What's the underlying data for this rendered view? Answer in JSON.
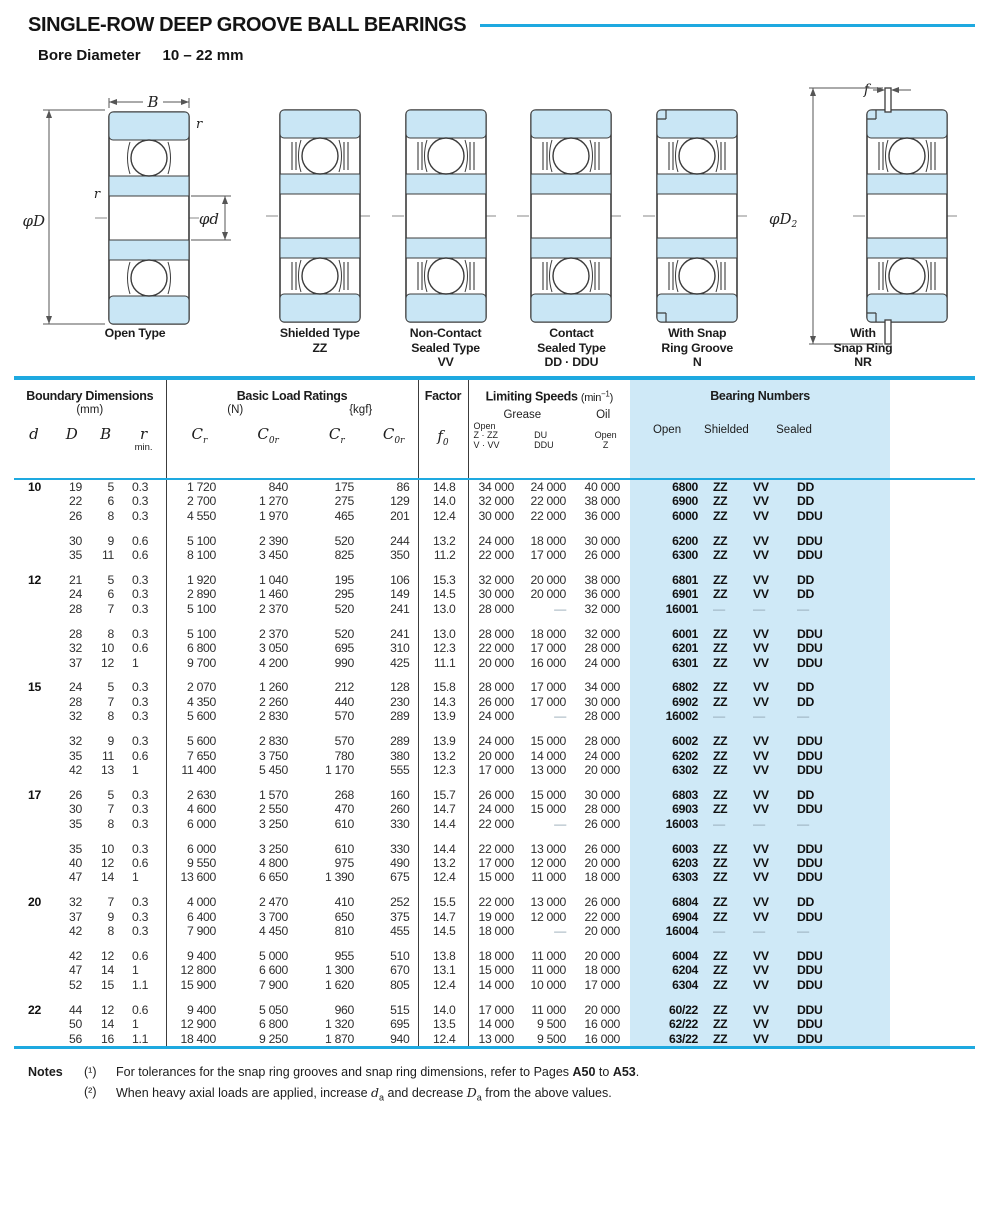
{
  "title": "SINGLE-ROW DEEP GROOVE BALL BEARINGS",
  "bore": {
    "label": "Bore Diameter",
    "value": "10 – 22 mm"
  },
  "colors": {
    "accent": "#1ea9e0",
    "panel": "#cfe9f7",
    "diagram_fill": "#c9e6f5"
  },
  "diagrams": [
    {
      "type": "open",
      "lines": [
        "Open Type",
        "",
        ""
      ]
    },
    {
      "type": "shielded",
      "lines": [
        "Shielded Type",
        "ZZ",
        ""
      ]
    },
    {
      "type": "vv",
      "lines": [
        "Non-Contact",
        "Sealed Type",
        "VV"
      ]
    },
    {
      "type": "dd",
      "lines": [
        "Contact",
        "Sealed Type",
        "DD · DDU"
      ]
    },
    {
      "type": "groove",
      "lines": [
        "With Snap",
        "Ring Groove",
        "N"
      ]
    },
    {
      "type": "ring",
      "lines": [
        "With",
        "Snap Ring",
        "NR"
      ]
    }
  ],
  "annotations": {
    "B": "B",
    "r": "r",
    "phiD": "φD",
    "phid": "φd",
    "f": "f",
    "phiD2": "φD",
    "phiD2_sub": "2"
  },
  "thead": {
    "boundary": {
      "title": "Boundary Dimensions",
      "unit": "(mm)",
      "d": "d",
      "D": "D",
      "B": "B",
      "r": "r",
      "r_min": "min."
    },
    "load": {
      "title": "Basic Load Ratings",
      "unit_n": "(N)",
      "unit_kgf": "{kgf}",
      "c": "C",
      "sub_r": "r",
      "sub_0r": "0r"
    },
    "factor": {
      "title": "Factor",
      "f": "f",
      "f_sub": "0"
    },
    "speeds": {
      "title": "Limiting Speeds",
      "unit_pre": "(min",
      "unit_sup": "−1",
      "unit_post": ")",
      "grease": "Grease",
      "oil": "Oil",
      "g1": [
        "Open",
        "Z · ZZ",
        "V · VV"
      ],
      "g2": [
        "DU",
        "DDU"
      ],
      "g3": [
        "Open",
        "Z"
      ]
    },
    "bearings": {
      "title": "Bearing Numbers",
      "open": "Open",
      "shielded": "Shielded",
      "sealed": "Sealed"
    }
  },
  "table": {
    "blocks": [
      {
        "d": "10",
        "rows": [
          [
            "19",
            "5",
            "0.3",
            "1 720",
            "840",
            "175",
            "86",
            "14.8",
            "34 000",
            "24 000",
            "40 000",
            "6800",
            "ZZ",
            "VV",
            "DD"
          ],
          [
            "22",
            "6",
            "0.3",
            "2 700",
            "1 270",
            "275",
            "129",
            "14.0",
            "32 000",
            "22 000",
            "38 000",
            "6900",
            "ZZ",
            "VV",
            "DD"
          ],
          [
            "26",
            "8",
            "0.3",
            "4 550",
            "1 970",
            "465",
            "201",
            "12.4",
            "30 000",
            "22 000",
            "36 000",
            "6000",
            "ZZ",
            "VV",
            "DDU"
          ]
        ]
      },
      {
        "d": "",
        "rows": [
          [
            "30",
            "9",
            "0.6",
            "5 100",
            "2 390",
            "520",
            "244",
            "13.2",
            "24 000",
            "18 000",
            "30 000",
            "6200",
            "ZZ",
            "VV",
            "DDU"
          ],
          [
            "35",
            "11",
            "0.6",
            "8 100",
            "3 450",
            "825",
            "350",
            "11.2",
            "22 000",
            "17 000",
            "26 000",
            "6300",
            "ZZ",
            "VV",
            "DDU"
          ]
        ]
      },
      {
        "d": "12",
        "rows": [
          [
            "21",
            "5",
            "0.3",
            "1 920",
            "1 040",
            "195",
            "106",
            "15.3",
            "32 000",
            "20 000",
            "38 000",
            "6801",
            "ZZ",
            "VV",
            "DD"
          ],
          [
            "24",
            "6",
            "0.3",
            "2 890",
            "1 460",
            "295",
            "149",
            "14.5",
            "30 000",
            "20 000",
            "36 000",
            "6901",
            "ZZ",
            "VV",
            "DD"
          ],
          [
            "28",
            "7",
            "0.3",
            "5 100",
            "2 370",
            "520",
            "241",
            "13.0",
            "28 000",
            "—",
            "32 000",
            "16001",
            "—",
            "—",
            "—"
          ]
        ]
      },
      {
        "d": "",
        "rows": [
          [
            "28",
            "8",
            "0.3",
            "5 100",
            "2 370",
            "520",
            "241",
            "13.0",
            "28 000",
            "18 000",
            "32 000",
            "6001",
            "ZZ",
            "VV",
            "DDU"
          ],
          [
            "32",
            "10",
            "0.6",
            "6 800",
            "3 050",
            "695",
            "310",
            "12.3",
            "22 000",
            "17 000",
            "28 000",
            "6201",
            "ZZ",
            "VV",
            "DDU"
          ],
          [
            "37",
            "12",
            "1",
            "9 700",
            "4 200",
            "990",
            "425",
            "11.1",
            "20 000",
            "16 000",
            "24 000",
            "6301",
            "ZZ",
            "VV",
            "DDU"
          ]
        ]
      },
      {
        "d": "15",
        "rows": [
          [
            "24",
            "5",
            "0.3",
            "2 070",
            "1 260",
            "212",
            "128",
            "15.8",
            "28 000",
            "17 000",
            "34 000",
            "6802",
            "ZZ",
            "VV",
            "DD"
          ],
          [
            "28",
            "7",
            "0.3",
            "4 350",
            "2 260",
            "440",
            "230",
            "14.3",
            "26 000",
            "17 000",
            "30 000",
            "6902",
            "ZZ",
            "VV",
            "DD"
          ],
          [
            "32",
            "8",
            "0.3",
            "5 600",
            "2 830",
            "570",
            "289",
            "13.9",
            "24 000",
            "—",
            "28 000",
            "16002",
            "—",
            "—",
            "—"
          ]
        ]
      },
      {
        "d": "",
        "rows": [
          [
            "32",
            "9",
            "0.3",
            "5 600",
            "2 830",
            "570",
            "289",
            "13.9",
            "24 000",
            "15 000",
            "28 000",
            "6002",
            "ZZ",
            "VV",
            "DDU"
          ],
          [
            "35",
            "11",
            "0.6",
            "7 650",
            "3 750",
            "780",
            "380",
            "13.2",
            "20 000",
            "14 000",
            "24 000",
            "6202",
            "ZZ",
            "VV",
            "DDU"
          ],
          [
            "42",
            "13",
            "1",
            "11 400",
            "5 450",
            "1 170",
            "555",
            "12.3",
            "17 000",
            "13 000",
            "20 000",
            "6302",
            "ZZ",
            "VV",
            "DDU"
          ]
        ]
      },
      {
        "d": "17",
        "rows": [
          [
            "26",
            "5",
            "0.3",
            "2 630",
            "1 570",
            "268",
            "160",
            "15.7",
            "26 000",
            "15 000",
            "30 000",
            "6803",
            "ZZ",
            "VV",
            "DD"
          ],
          [
            "30",
            "7",
            "0.3",
            "4 600",
            "2 550",
            "470",
            "260",
            "14.7",
            "24 000",
            "15 000",
            "28 000",
            "6903",
            "ZZ",
            "VV",
            "DDU"
          ],
          [
            "35",
            "8",
            "0.3",
            "6 000",
            "3 250",
            "610",
            "330",
            "14.4",
            "22 000",
            "—",
            "26 000",
            "16003",
            "—",
            "—",
            "—"
          ]
        ]
      },
      {
        "d": "",
        "rows": [
          [
            "35",
            "10",
            "0.3",
            "6 000",
            "3 250",
            "610",
            "330",
            "14.4",
            "22 000",
            "13 000",
            "26 000",
            "6003",
            "ZZ",
            "VV",
            "DDU"
          ],
          [
            "40",
            "12",
            "0.6",
            "9 550",
            "4 800",
            "975",
            "490",
            "13.2",
            "17 000",
            "12 000",
            "20 000",
            "6203",
            "ZZ",
            "VV",
            "DDU"
          ],
          [
            "47",
            "14",
            "1",
            "13 600",
            "6 650",
            "1 390",
            "675",
            "12.4",
            "15 000",
            "11 000",
            "18 000",
            "6303",
            "ZZ",
            "VV",
            "DDU"
          ]
        ]
      },
      {
        "d": "20",
        "rows": [
          [
            "32",
            "7",
            "0.3",
            "4 000",
            "2 470",
            "410",
            "252",
            "15.5",
            "22 000",
            "13 000",
            "26 000",
            "6804",
            "ZZ",
            "VV",
            "DD"
          ],
          [
            "37",
            "9",
            "0.3",
            "6 400",
            "3 700",
            "650",
            "375",
            "14.7",
            "19 000",
            "12 000",
            "22 000",
            "6904",
            "ZZ",
            "VV",
            "DDU"
          ],
          [
            "42",
            "8",
            "0.3",
            "7 900",
            "4 450",
            "810",
            "455",
            "14.5",
            "18 000",
            "—",
            "20 000",
            "16004",
            "—",
            "—",
            "—"
          ]
        ]
      },
      {
        "d": "",
        "rows": [
          [
            "42",
            "12",
            "0.6",
            "9 400",
            "5 000",
            "955",
            "510",
            "13.8",
            "18 000",
            "11 000",
            "20 000",
            "6004",
            "ZZ",
            "VV",
            "DDU"
          ],
          [
            "47",
            "14",
            "1",
            "12 800",
            "6 600",
            "1 300",
            "670",
            "13.1",
            "15 000",
            "11 000",
            "18 000",
            "6204",
            "ZZ",
            "VV",
            "DDU"
          ],
          [
            "52",
            "15",
            "1.1",
            "15 900",
            "7 900",
            "1 620",
            "805",
            "12.4",
            "14 000",
            "10 000",
            "17 000",
            "6304",
            "ZZ",
            "VV",
            "DDU"
          ]
        ]
      },
      {
        "d": "22",
        "rows": [
          [
            "44",
            "12",
            "0.6",
            "9 400",
            "5 050",
            "960",
            "515",
            "14.0",
            "17 000",
            "11 000",
            "20 000",
            "60/22",
            "ZZ",
            "VV",
            "DDU"
          ],
          [
            "50",
            "14",
            "1",
            "12 900",
            "6 800",
            "1 320",
            "695",
            "13.5",
            "14 000",
            "9 500",
            "16 000",
            "62/22",
            "ZZ",
            "VV",
            "DDU"
          ],
          [
            "56",
            "16",
            "1.1",
            "18 400",
            "9 250",
            "1 870",
            "940",
            "12.4",
            "13 000",
            "9 500",
            "16 000",
            "63/22",
            "ZZ",
            "VV",
            "DDU"
          ]
        ]
      }
    ]
  },
  "notes": {
    "label": "Notes",
    "n1": {
      "sup": "(¹)",
      "pre": "For tolerances for the snap ring grooves and snap ring dimensions, refer to Pages ",
      "b1": "A50",
      "mid": " to ",
      "b2": "A53",
      "post": "."
    },
    "n2": {
      "sup": "(²)",
      "pre": "When heavy axial loads are applied, increase ",
      "i1": "d",
      "s1": "a",
      "mid": " and decrease ",
      "i2": "D",
      "s2": "a",
      "post": " from the above values."
    }
  }
}
